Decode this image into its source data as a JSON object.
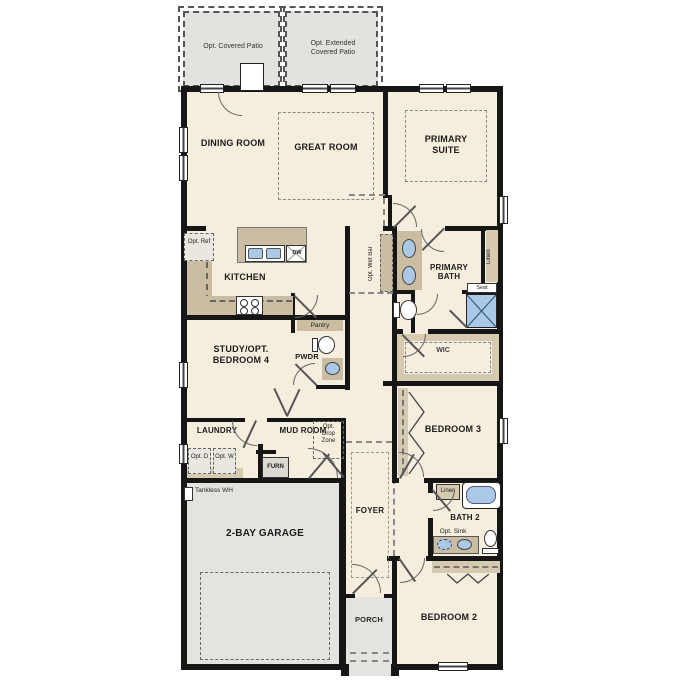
{
  "patios": {
    "covered": "Opt. Covered Patio",
    "extended": "Opt. Extended Covered Patio"
  },
  "rooms": {
    "dining": "DINING ROOM",
    "great": "GREAT ROOM",
    "primary_suite": "PRIMARY SUITE",
    "kitchen": "KITCHEN",
    "primary_bath": "PRIMARY BATH",
    "wic": "WIC",
    "study": "STUDY/OPT. BEDROOM 4",
    "pwdr": "PWDR",
    "laundry": "LAUNDRY",
    "mud_room": "MUD ROOM",
    "bedroom3": "BEDROOM 3",
    "garage": "2-BAY GARAGE",
    "foyer": "FOYER",
    "bath2": "BATH 2",
    "bedroom2": "BEDROOM 2",
    "porch": "PORCH"
  },
  "fixtures": {
    "opt_ref": "Opt. Ref",
    "dishwasher": "DW",
    "pantry": "Pantry",
    "opt_wet_bar": "Opt. Wet Bar",
    "linen_primary": "Linen",
    "seat": "Seat",
    "opt_drop_zone": "Opt. Drop Zone",
    "opt_dryer": "Opt. D",
    "opt_washer": "Opt. W",
    "furnace": "FURN",
    "tankless_wh": "Tankless WH",
    "linen_bath2": "Linen",
    "opt_sink": "Opt. Sink"
  },
  "colors": {
    "floor": "#f5eddd",
    "patio": "#e3e2df",
    "garage_floor": "#e4e3e0",
    "counter_tan": "#cbbda1",
    "shelf_tan": "#d6cab0",
    "fixture_blue": "#abc9e6",
    "wall": "#161616"
  }
}
